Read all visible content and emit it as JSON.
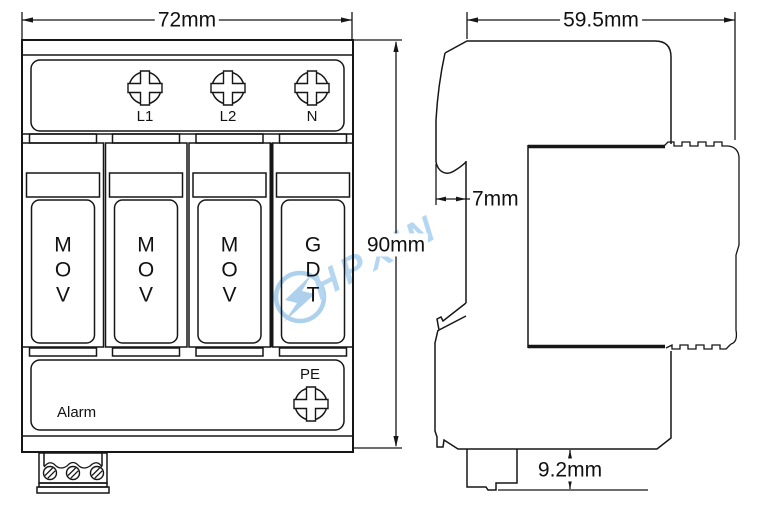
{
  "watermark": {
    "text": "HPXIN"
  },
  "dimensions": {
    "front_width": "72mm",
    "front_height": "90mm",
    "side_depth": "59.5mm",
    "front_lip": "7mm",
    "rail_offset": "9.2mm"
  },
  "front_view": {
    "terminals": [
      {
        "label": "L1"
      },
      {
        "label": "L2"
      },
      {
        "label": "N"
      }
    ],
    "modules": [
      {
        "label": "M\nO\nV"
      },
      {
        "label": "M\nO\nV"
      },
      {
        "label": "M\nO\nV"
      },
      {
        "label": "G\nD\nT"
      }
    ],
    "pe_label": "PE",
    "alarm_label": "Alarm"
  }
}
